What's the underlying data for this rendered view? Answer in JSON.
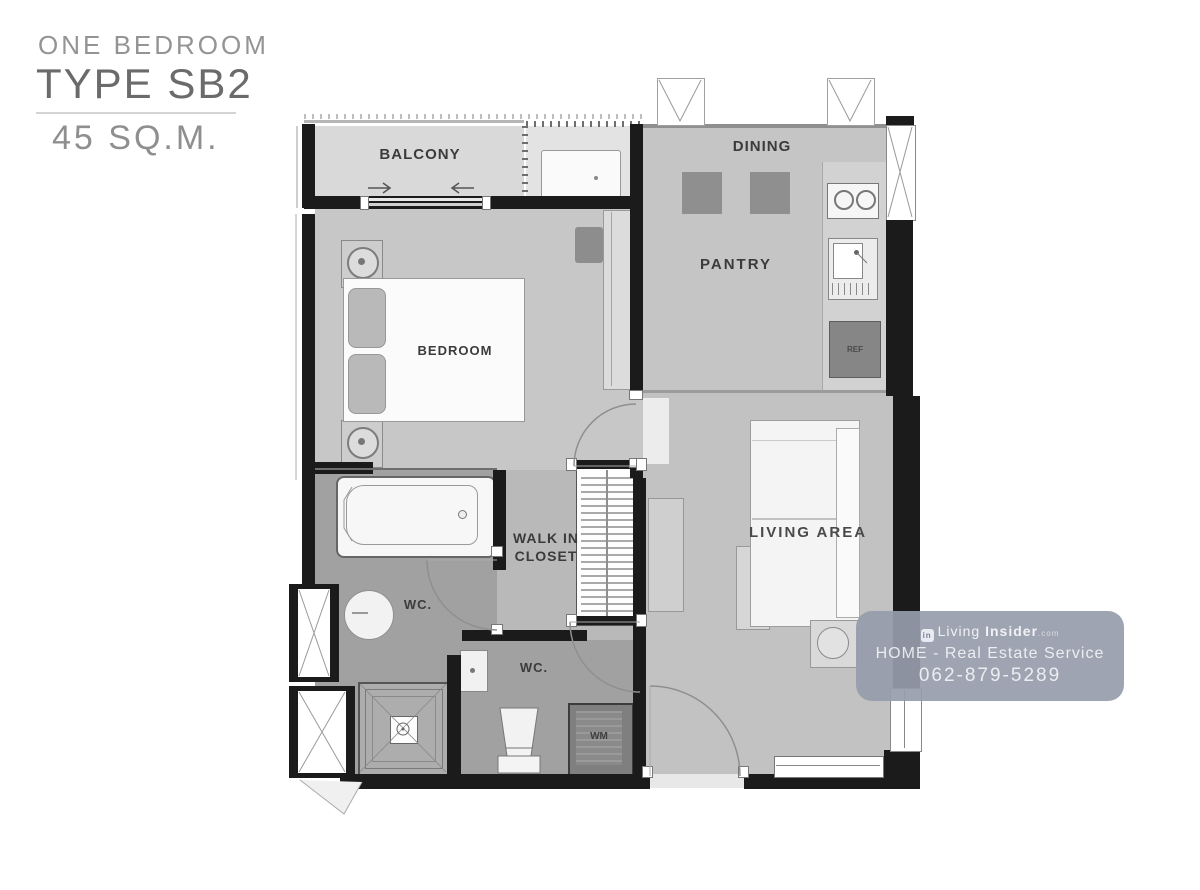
{
  "title": {
    "subtitle": "ONE BEDROOM",
    "type_name": "TYPE SB2",
    "area": "45 SQ.M."
  },
  "rooms": {
    "balcony": "BALCONY",
    "dining": "DINING",
    "pantry": "PANTRY",
    "bedroom": "BEDROOM",
    "walk_in_closet_line1": "WALK IN",
    "walk_in_closet_line2": "CLOSET",
    "wc_bath": "WC.",
    "wc_toilet": "WC.",
    "living": "LIVING AREA"
  },
  "appliances": {
    "refrigerator": "REF",
    "washing_machine": "WM"
  },
  "watermark": {
    "brand_prefix": "Living",
    "brand_suffix": "Insider",
    "brand_tld": ".com",
    "icon_glyph": "in",
    "service_line": "HOME - Real Estate Service",
    "phone": "062-879-5289"
  },
  "colors": {
    "wall": "#1b1b1b",
    "floor_main": "#c6c6c6",
    "floor_wet": "#a1a1a1",
    "floor_balcony": "#d9d9d9",
    "furniture_dark": "#8f8f8f",
    "watermark_bg": "#969cab"
  }
}
